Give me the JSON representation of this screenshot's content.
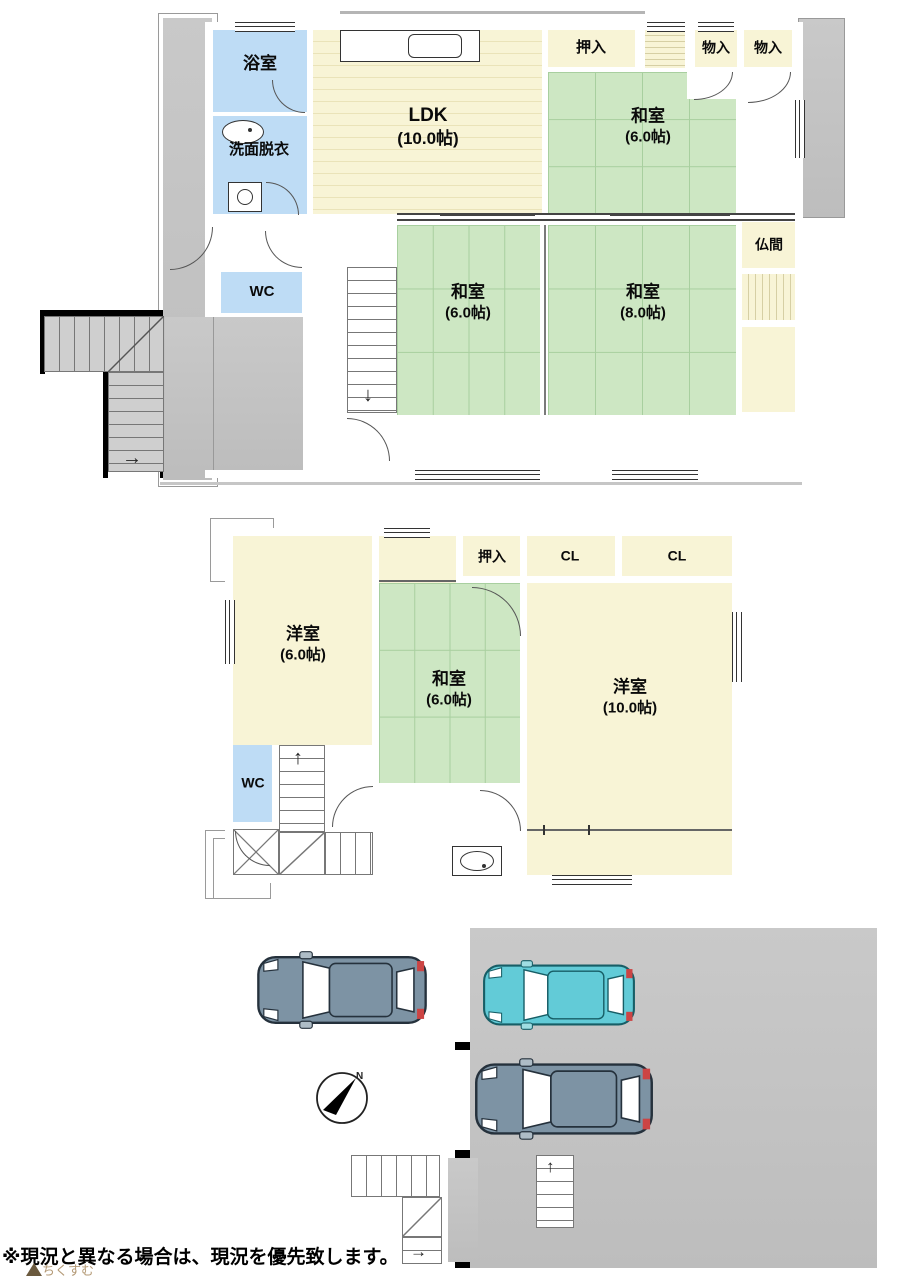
{
  "floor1": {
    "rooms": [
      {
        "name": "浴室",
        "size": ""
      },
      {
        "name": "洗面脱衣",
        "size": ""
      },
      {
        "name": "LDK",
        "size": "(10.0帖)"
      },
      {
        "name": "押入",
        "size": ""
      },
      {
        "name": "物入",
        "size": ""
      },
      {
        "name": "物入",
        "size": ""
      },
      {
        "name": "和室",
        "size": "(6.0帖)"
      },
      {
        "name": "仏間",
        "size": ""
      },
      {
        "name": "和室",
        "size": "(6.0帖)"
      },
      {
        "name": "和室",
        "size": "(8.0帖)"
      },
      {
        "name": "WC",
        "size": ""
      }
    ]
  },
  "floor2": {
    "rooms": [
      {
        "name": "洋室",
        "size": "(6.0帖)"
      },
      {
        "name": "押入",
        "size": ""
      },
      {
        "name": "CL",
        "size": ""
      },
      {
        "name": "CL",
        "size": ""
      },
      {
        "name": "和室",
        "size": "(6.0帖)"
      },
      {
        "name": "洋室",
        "size": "(10.0帖)"
      },
      {
        "name": "WC",
        "size": ""
      }
    ]
  },
  "site": {
    "compass_label": "N",
    "cars": [
      {
        "id": "car-1",
        "color": "#7d93a4"
      },
      {
        "id": "car-2",
        "color": "#62cbd7"
      },
      {
        "id": "car-3",
        "color": "#7d93a4"
      }
    ]
  },
  "note": {
    "text": "※現況と異なる場合は、現況を優先致します。"
  },
  "watermark": {
    "text": "ちくすむ"
  },
  "colors": {
    "tatami_green": "#cde7c3",
    "room_cream": "#f8f4d6",
    "wet_blue": "#bedcf5",
    "exterior_gray": "#c4c4c4",
    "wall_black": "#000000",
    "car_gray": "#7d93a4",
    "car_teal": "#62cbd7",
    "tail_red": "#cc4444"
  }
}
